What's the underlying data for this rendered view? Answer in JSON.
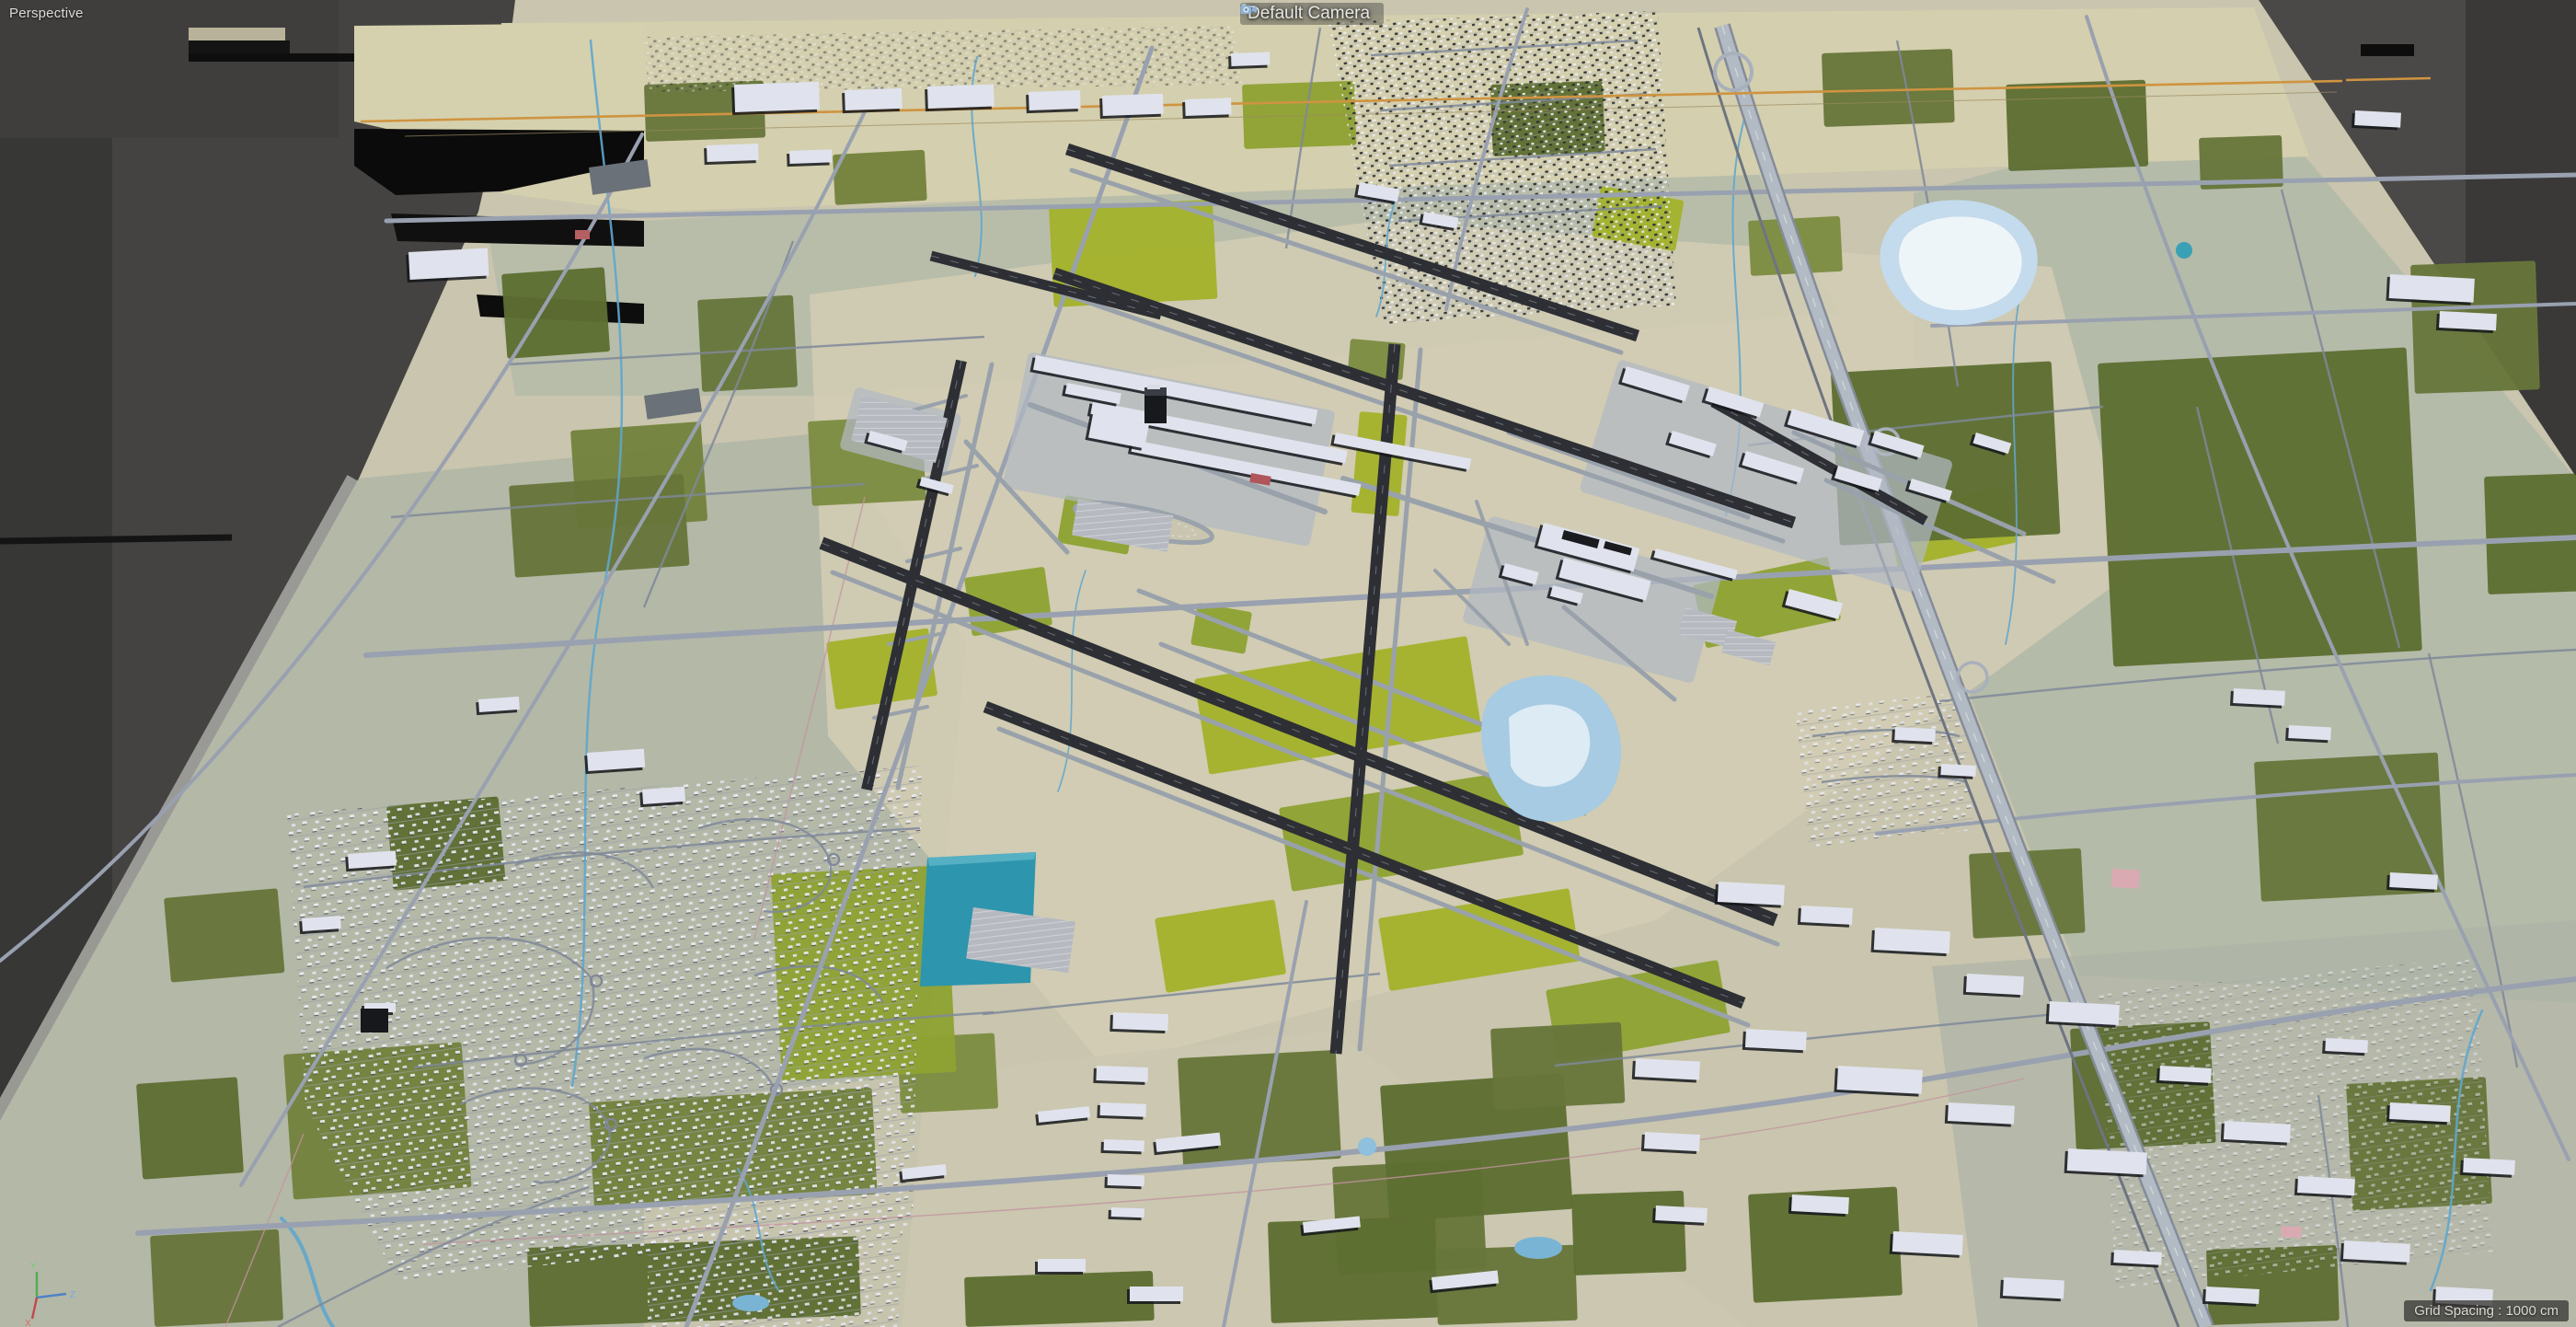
{
  "viewport": {
    "mode_label": "Perspective",
    "camera": {
      "label": "Default Camera",
      "icon": "camera-icon"
    },
    "status": {
      "grid_spacing_label": "Grid Spacing : 1000 cm"
    },
    "gizmo": {
      "y_label": "Y",
      "z_label": "Z",
      "x_label": "X"
    }
  },
  "colors": {
    "viewport_bg": "#454341",
    "viewport_bg_dark": "#373736",
    "viewport_bg_right": "#3a3938",
    "panel_bg": "#403e3d",
    "ground_tan": "#c9c5ae",
    "ground_sage": "#aeb4a5",
    "rail_strip_beige": "#d4cfae",
    "field_olive": "#73823c",
    "field_dark_green": "#5e6e32",
    "airfield_green": "#a3b22c",
    "road_gray": "#8791a3",
    "highway_gray": "#b2bac4",
    "runway_dark": "#2d2f34",
    "taxiway_gray": "#99a1ab",
    "building_white": "#e0e3ed",
    "building_shadow": "#15161b",
    "water_blue": "#a6cbe2",
    "water_teal": "#2d95ad",
    "water_shine": "#eef5f9",
    "railway_orange": "#cf9440",
    "label_text": "#dedbd6"
  }
}
